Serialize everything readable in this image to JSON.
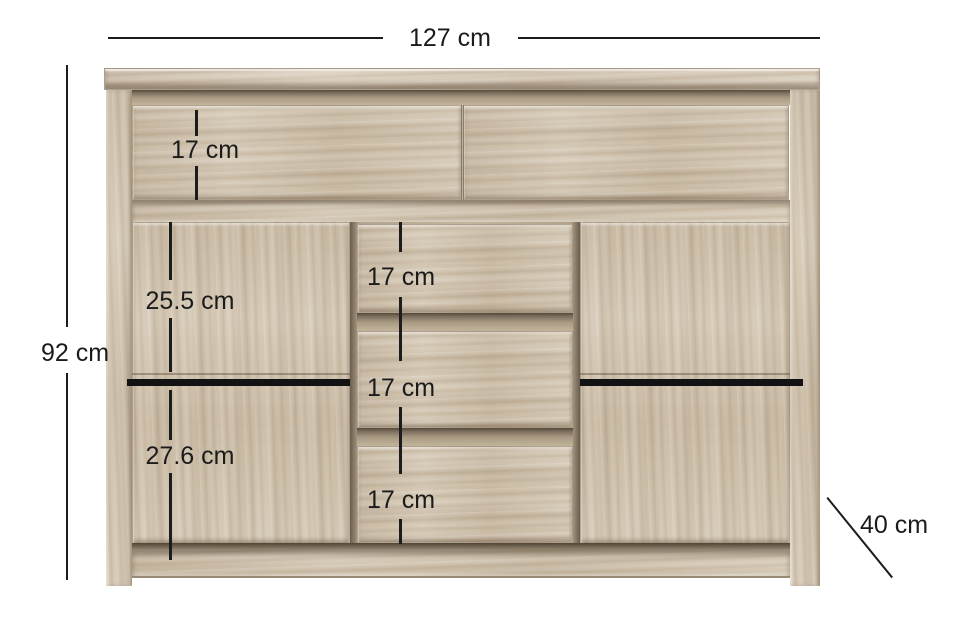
{
  "diagram": {
    "type": "furniture-dimension-diagram",
    "item": "sideboard-with-two-doors-and-drawers",
    "colors": {
      "background": "#ffffff",
      "wood_base": "#d2c5b0",
      "wood_shadow": "#57493b",
      "annotation": "#1c1c1c"
    },
    "dimensions": {
      "width_label": "127 cm",
      "height_label": "92 cm",
      "depth_label": "40 cm",
      "top_drawer_label": "17 cm",
      "door_upper_label": "25.5 cm",
      "door_lower_label": "27.6 cm",
      "middle_drawer_labels": [
        "17 cm",
        "17 cm",
        "17 cm"
      ]
    }
  }
}
